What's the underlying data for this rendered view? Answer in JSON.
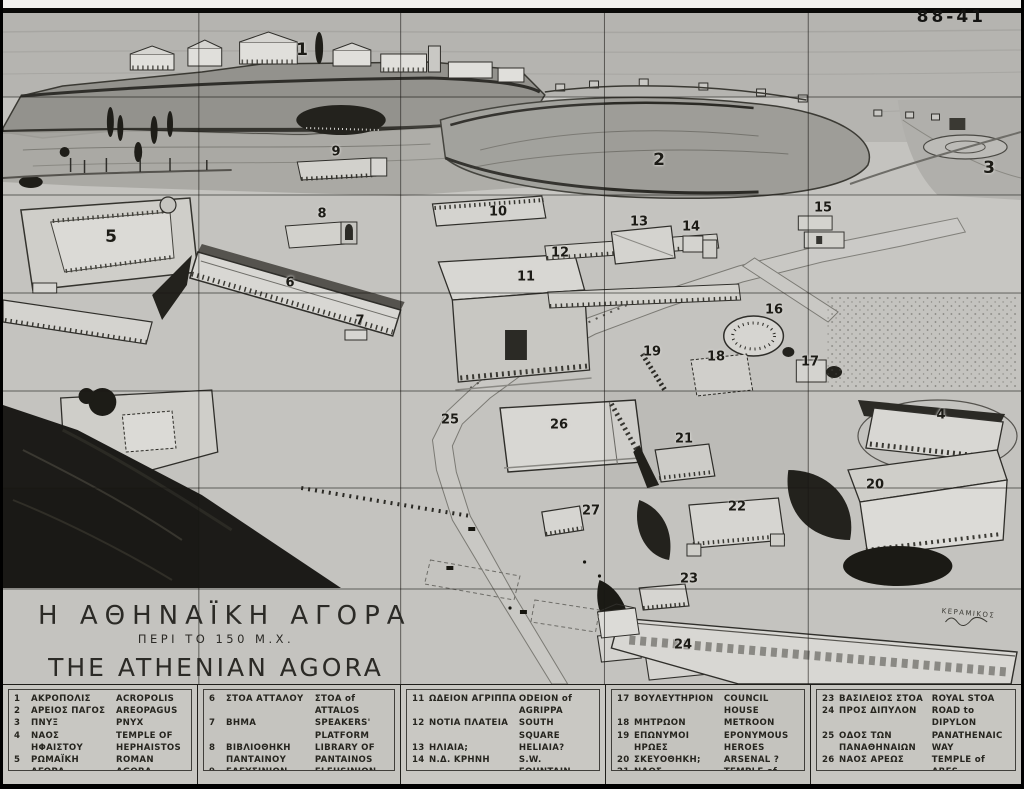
{
  "photo": {
    "negative_number": "88-41"
  },
  "title": {
    "greek": "Η ΑΘΗΝΑΪΚΗ ΑΓΟΡΑ",
    "greek_sub": "ΠΕΡΙ ΤΟ 150 Μ.Χ.",
    "english": "THE ATHENIAN AGORA",
    "english_sub": "ABOUT A.D 150"
  },
  "map": {
    "district_label": "ΚΕΡΑΜΙΚΟΣ",
    "markers": [
      {
        "n": "1",
        "x": 302,
        "y": 50,
        "size": "lg"
      },
      {
        "n": "2",
        "x": 659,
        "y": 160,
        "size": "lg"
      },
      {
        "n": "3",
        "x": 989,
        "y": 168,
        "size": "lg"
      },
      {
        "n": "4",
        "x": 941,
        "y": 415,
        "size": "md"
      },
      {
        "n": "5",
        "x": 111,
        "y": 237,
        "size": "lg"
      },
      {
        "n": "6",
        "x": 290,
        "y": 283,
        "size": "md"
      },
      {
        "n": "7",
        "x": 360,
        "y": 321,
        "size": "md"
      },
      {
        "n": "8",
        "x": 322,
        "y": 214,
        "size": "md"
      },
      {
        "n": "9",
        "x": 336,
        "y": 152,
        "size": "md"
      },
      {
        "n": "10",
        "x": 498,
        "y": 212,
        "size": "md"
      },
      {
        "n": "11",
        "x": 526,
        "y": 277,
        "size": "md"
      },
      {
        "n": "12",
        "x": 560,
        "y": 253,
        "size": "md"
      },
      {
        "n": "13",
        "x": 639,
        "y": 222,
        "size": "md"
      },
      {
        "n": "14",
        "x": 691,
        "y": 227,
        "size": "md"
      },
      {
        "n": "15",
        "x": 823,
        "y": 208,
        "size": "md"
      },
      {
        "n": "16",
        "x": 774,
        "y": 310,
        "size": "md"
      },
      {
        "n": "17",
        "x": 810,
        "y": 362,
        "size": "md"
      },
      {
        "n": "18",
        "x": 716,
        "y": 357,
        "size": "md"
      },
      {
        "n": "19",
        "x": 652,
        "y": 352,
        "size": "md"
      },
      {
        "n": "20",
        "x": 875,
        "y": 485,
        "size": "md"
      },
      {
        "n": "21",
        "x": 684,
        "y": 439,
        "size": "md"
      },
      {
        "n": "22",
        "x": 737,
        "y": 507,
        "size": "md"
      },
      {
        "n": "23",
        "x": 689,
        "y": 579,
        "size": "md"
      },
      {
        "n": "24",
        "x": 683,
        "y": 645,
        "size": "md"
      },
      {
        "n": "25",
        "x": 450,
        "y": 420,
        "size": "md"
      },
      {
        "n": "26",
        "x": 559,
        "y": 425,
        "size": "md"
      },
      {
        "n": "27",
        "x": 591,
        "y": 511,
        "size": "md"
      }
    ]
  },
  "legend": {
    "columns": [
      [
        {
          "n": "1",
          "gr": "ΑΚΡΟΠΟΛΙΣ",
          "en": "ACROPOLIS"
        },
        {
          "n": "2",
          "gr": "ΑΡΕΙΟΣ ΠΑΓΟΣ",
          "en": "AREOPAGUS"
        },
        {
          "n": "3",
          "gr": "ΠΝΥΞ",
          "en": "PNYX"
        },
        {
          "n": "4",
          "gr": "ΝΑΟΣ\n ΗΦΑΙΣΤΟΥ",
          "en": "TEMPLE OF\n HEPHAISTOS"
        },
        {
          "n": "5",
          "gr": "ΡΩΜΑΪΚΗ ΑΓΟΡΑ",
          "en": "ROMAN AGORA"
        }
      ],
      [
        {
          "n": "6",
          "gr": "ΣΤΟΑ ΑΤΤΑΛΟΥ",
          "en": "ΣΤΟΑ of ATTALOS"
        },
        {
          "n": "7",
          "gr": "ΒΗΜΑ",
          "en": "SPEAKERS' PLATFORM"
        },
        {
          "n": "8",
          "gr": "ΒΙΒΛΙΟΘΗΚΗ\n ΠΑΝΤΑΙΝΟΥ",
          "en": "LIBRARY OF\n PANTAINOS"
        },
        {
          "n": "9",
          "gr": "ΕΛΕΥΣΙΝΙΟΝ",
          "en": "ELEUSINION"
        },
        {
          "n": "10",
          "gr": "ΕΝΝΕΑΚΡΟΥΝΟΣ;",
          "en": "ENNEAKROUNOS?"
        }
      ],
      [
        {
          "n": "11",
          "gr": "ΩΔΕΙΟΝ ΑΓΡΙΠΠΑ",
          "en": "ODEION of AGRIPPA"
        },
        {
          "n": "12",
          "gr": "ΝΟΤΙΑ ΠΛΑΤΕΙΑ",
          "en": "SOUTH SQUARE"
        },
        {
          "n": "13",
          "gr": "ΗΛΙΑΙΑ;",
          "en": "HELIAIA?"
        },
        {
          "n": "14",
          "gr": "Ν.Δ. ΚΡΗΝΗ",
          "en": "S.W. FOUNTAIN"
        },
        {
          "n": "15",
          "gr": "ΦΥΛΑΚΑΙ",
          "en": "STATE PRISON"
        },
        {
          "n": "16",
          "gr": "ΘΟΛΟΣ",
          "en": "THOLOS"
        }
      ],
      [
        {
          "n": "17",
          "gr": "ΒΟΥΛΕΥΤΗΡΙΟΝ",
          "en": "COUNCIL HOUSE"
        },
        {
          "n": "18",
          "gr": "ΜΗΤΡΩΟΝ",
          "en": "METROON"
        },
        {
          "n": "19",
          "gr": "ΕΠΩΝΥΜΟΙ ΗΡΩΕΣ",
          "en": "EPONYMOUS HEROES"
        },
        {
          "n": "20",
          "gr": "ΣΚΕΥΟΘΗΚΗ;",
          "en": "ARSENAL ?"
        },
        {
          "n": "21",
          "gr": "ΝΑΟΣ ΑΠΟΛΛΩΝΟΣ",
          "en": "TEMPLE of APOLLO"
        },
        {
          "n": "22",
          "gr": "ΣΤΟΑ ΔΙΟΣ",
          "en": "STOA of ZEUS"
        }
      ],
      [
        {
          "n": "23",
          "gr": "ΒΑΣΙΛΕΙΟΣ ΣΤΟΑ",
          "en": "ROYAL STOA"
        },
        {
          "n": "24",
          "gr": "ΠΡΟΣ ΔΙΠΥΛΟΝ",
          "en": "ROAD to DIPYLON"
        },
        {
          "n": "25",
          "gr": "ΟΔΟΣ ΤΩΝ\n ΠΑΝΑΘΗΝΑΙΩΝ",
          "en": "PANATHENAIC\n WAY"
        },
        {
          "n": "26",
          "gr": "ΝΑΟΣ ΑΡΕΩΣ",
          "en": "TEMPLE of ARES"
        },
        {
          "n": "27",
          "gr": "ΒΩΜΟΣ 12 ΘΕΩΝ",
          "en": "ALTAR of 12 GODS"
        }
      ]
    ]
  }
}
